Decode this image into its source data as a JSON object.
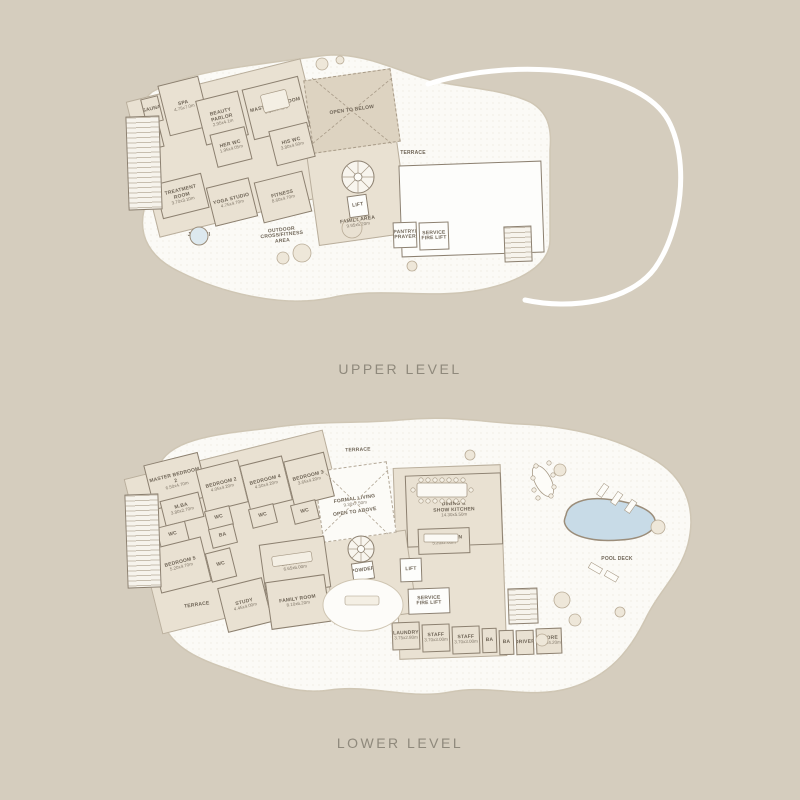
{
  "titles": {
    "upper": "UPPER LEVEL",
    "lower": "LOWER LEVEL"
  },
  "colors": {
    "background": "#d5cdbe",
    "deck": "#fbfaf6",
    "room": "#e9e1d2",
    "wall": "#8c8070",
    "open_fill": "#ddd3c1",
    "pool": "#c8dbe7",
    "text": "#6f6557",
    "title_text": "#8f897c",
    "boundary": "#ffffff"
  },
  "upper_plan": {
    "rooms": [
      {
        "id": "wing-slab",
        "name": "",
        "x": 140,
        "y": 78,
        "w": 180,
        "h": 140,
        "r": -14,
        "type": "slab"
      },
      {
        "id": "mid-slab",
        "name": "",
        "x": 312,
        "y": 146,
        "w": 92,
        "h": 94,
        "r": -8,
        "type": "slab"
      },
      {
        "id": "right-wing",
        "name": "",
        "x": 400,
        "y": 163,
        "w": 143,
        "h": 92,
        "r": -2,
        "type": "white"
      },
      {
        "id": "open-to-below",
        "name": "OPEN TO BELOW",
        "x": 308,
        "y": 74,
        "w": 88,
        "h": 74,
        "r": -8,
        "type": "open"
      },
      {
        "id": "sauna",
        "name": "SAUNA",
        "x": 143,
        "y": 97,
        "w": 18,
        "h": 26,
        "r": -14,
        "type": "std"
      },
      {
        "id": "steam",
        "name": "STEAM",
        "x": 144,
        "y": 125,
        "w": 18,
        "h": 24,
        "r": -14,
        "type": "std"
      },
      {
        "id": "spa",
        "name": "SPA",
        "dims": "4.75x7.0m",
        "x": 163,
        "y": 80,
        "w": 42,
        "h": 52,
        "r": -14,
        "type": "std"
      },
      {
        "id": "beauty-parlor",
        "name": "BEAUTY PARLOR",
        "dims": "2.95x4.1m",
        "x": 200,
        "y": 95,
        "w": 44,
        "h": 46,
        "r": -14,
        "type": "std"
      },
      {
        "id": "master-bedroom",
        "name": "MASTER BEDROOM",
        "dims": "8.35x4.45m",
        "x": 247,
        "y": 82,
        "w": 58,
        "h": 52,
        "r": -14,
        "type": "std"
      },
      {
        "id": "her-wc",
        "name": "HER WC",
        "dims": "1.95x4.05m",
        "x": 213,
        "y": 130,
        "w": 36,
        "h": 34,
        "r": -14,
        "type": "std"
      },
      {
        "id": "his-wc",
        "name": "HIS WC",
        "dims": "3.80x4.50m",
        "x": 272,
        "y": 126,
        "w": 40,
        "h": 36,
        "r": -14,
        "type": "std"
      },
      {
        "id": "treatment-room",
        "name": "TREATMENT ROOM",
        "dims": "3.70x3.10m",
        "x": 158,
        "y": 178,
        "w": 48,
        "h": 36,
        "r": -14,
        "type": "std"
      },
      {
        "id": "yoga-studio",
        "name": "YOGA STUDIO",
        "dims": "4.75x4.70m",
        "x": 210,
        "y": 182,
        "w": 44,
        "h": 40,
        "r": -14,
        "type": "std"
      },
      {
        "id": "fitness",
        "name": "FITNESS",
        "dims": "8.60x4.70m",
        "x": 258,
        "y": 176,
        "w": 50,
        "h": 42,
        "r": -14,
        "type": "std"
      },
      {
        "id": "lift",
        "name": "LIFT",
        "x": 348,
        "y": 195,
        "w": 20,
        "h": 22,
        "r": -8,
        "type": "white"
      },
      {
        "id": "pantry-prayer",
        "name": "PANTRY/\nPRAYER",
        "x": 393,
        "y": 222,
        "w": 24,
        "h": 26,
        "r": -2,
        "type": "white"
      },
      {
        "id": "service-fire-lift",
        "name": "SERVICE\nFIRE LIFT",
        "x": 419,
        "y": 222,
        "w": 30,
        "h": 28,
        "r": -2,
        "type": "white"
      },
      {
        "id": "stair-right",
        "name": "",
        "x": 504,
        "y": 226,
        "w": 28,
        "h": 36,
        "r": -2,
        "type": "stairbox"
      },
      {
        "id": "core-left",
        "name": "",
        "x": 127,
        "y": 116,
        "w": 34,
        "h": 94,
        "r": -2,
        "type": "stairbox"
      },
      {
        "id": "family-area-label",
        "name": "FAMILY AREA",
        "dims": "9.95x5.20m",
        "x": 322,
        "y": 214,
        "w": 72,
        "h": 18,
        "r": -8,
        "type": "label"
      },
      {
        "id": "terrace-label",
        "name": "TERRACE",
        "x": 392,
        "y": 148,
        "w": 42,
        "h": 12,
        "r": 0,
        "type": "label"
      },
      {
        "id": "outdoor-area-label",
        "name": "OUTDOOR\nCROSS/FITNESS\nAREA",
        "x": 248,
        "y": 224,
        "w": 68,
        "h": 24,
        "r": -6,
        "type": "label"
      },
      {
        "id": "jacuzzi-label",
        "name": "JACUZZI",
        "x": 185,
        "y": 230,
        "w": 28,
        "h": 12,
        "r": 0,
        "type": "label"
      }
    ]
  },
  "lower_plan": {
    "rooms": [
      {
        "id": "wing-slab",
        "name": "",
        "x": 140,
        "y": 452,
        "w": 205,
        "h": 160,
        "r": -14,
        "type": "slab"
      },
      {
        "id": "right-slab",
        "name": "",
        "x": 396,
        "y": 466,
        "w": 108,
        "h": 192,
        "r": -2,
        "type": "slab"
      },
      {
        "id": "mid-slab",
        "name": "",
        "x": 328,
        "y": 535,
        "w": 84,
        "h": 84,
        "r": -8,
        "type": "slab"
      },
      {
        "id": "formal-living",
        "name": "FORMAL LIVING",
        "dims": "9.30x7.50m",
        "x": 318,
        "y": 466,
        "w": 74,
        "h": 72,
        "r": -8,
        "type": "openwhite"
      },
      {
        "id": "master-bedroom-2",
        "name": "MASTER BEDROOM 2",
        "dims": "6.50x4.70m",
        "x": 148,
        "y": 458,
        "w": 56,
        "h": 46,
        "r": -14,
        "type": "std"
      },
      {
        "id": "m-ba",
        "name": "M.BA",
        "dims": "3.80x2.70m",
        "x": 162,
        "y": 496,
        "w": 40,
        "h": 26,
        "r": -14,
        "type": "std"
      },
      {
        "id": "wc-mb2",
        "name": "WC",
        "x": 158,
        "y": 524,
        "w": 30,
        "h": 22,
        "r": -14,
        "type": "std"
      },
      {
        "id": "bedroom-5",
        "name": "BEDROOM 5",
        "dims": "5.20x4.70m",
        "x": 155,
        "y": 542,
        "w": 52,
        "h": 46,
        "r": -14,
        "type": "std"
      },
      {
        "id": "wc-b5",
        "name": "WC",
        "x": 208,
        "y": 550,
        "w": 26,
        "h": 30,
        "r": -14,
        "type": "std"
      },
      {
        "id": "bedroom-2",
        "name": "BEDROOM 2",
        "dims": "4.05x4.20m",
        "x": 200,
        "y": 464,
        "w": 44,
        "h": 44,
        "r": -14,
        "type": "std"
      },
      {
        "id": "wc-b2",
        "name": "WC",
        "x": 206,
        "y": 508,
        "w": 26,
        "h": 20,
        "r": -14,
        "type": "std"
      },
      {
        "id": "ba-b2",
        "name": "BA",
        "x": 210,
        "y": 526,
        "w": 26,
        "h": 20,
        "r": -14,
        "type": "std"
      },
      {
        "id": "bedroom-4",
        "name": "BEDROOM 4",
        "dims": "4.50x4.20m",
        "x": 244,
        "y": 460,
        "w": 44,
        "h": 46,
        "r": -14,
        "type": "std"
      },
      {
        "id": "wc-b4",
        "name": "WC",
        "x": 250,
        "y": 506,
        "w": 26,
        "h": 20,
        "r": -14,
        "type": "std"
      },
      {
        "id": "bedroom-3",
        "name": "BEDROOM 3",
        "dims": "3.65x4.20m",
        "x": 288,
        "y": 456,
        "w": 42,
        "h": 46,
        "r": -14,
        "type": "std"
      },
      {
        "id": "wc-b3",
        "name": "WC",
        "x": 292,
        "y": 502,
        "w": 26,
        "h": 20,
        "r": -14,
        "type": "std"
      },
      {
        "id": "dining-show-kitchen",
        "name": "DINING &\nSHOW KITCHEN",
        "dims": "14.30x5.50m",
        "x": 406,
        "y": 474,
        "w": 96,
        "h": 72,
        "r": -2,
        "type": "std"
      },
      {
        "id": "wet-kitchen",
        "name": "WET KITCHEN",
        "dims": "5.20x2.60m",
        "x": 418,
        "y": 528,
        "w": 52,
        "h": 26,
        "r": -2,
        "type": "std"
      },
      {
        "id": "lift",
        "name": "LIFT",
        "x": 400,
        "y": 558,
        "w": 22,
        "h": 24,
        "r": -2,
        "type": "white"
      },
      {
        "id": "media-room",
        "name": "MEDIA ROOM",
        "dims": "6.65x6.00m",
        "x": 262,
        "y": 540,
        "w": 66,
        "h": 52,
        "r": -8,
        "type": "std"
      },
      {
        "id": "study",
        "name": "STUDY",
        "dims": "4.45x4.00m",
        "x": 222,
        "y": 582,
        "w": 46,
        "h": 46,
        "r": -14,
        "type": "std"
      },
      {
        "id": "family-room",
        "name": "FAMILY ROOM",
        "dims": "8.10x6.20m",
        "x": 268,
        "y": 578,
        "w": 60,
        "h": 48,
        "r": -8,
        "type": "std"
      },
      {
        "id": "powder",
        "name": "POWDER",
        "x": 352,
        "y": 562,
        "w": 22,
        "h": 18,
        "r": -8,
        "type": "white"
      },
      {
        "id": "service-fire-lift",
        "name": "SERVICE\nFIRE LIFT",
        "x": 408,
        "y": 588,
        "w": 42,
        "h": 26,
        "r": -2,
        "type": "white"
      },
      {
        "id": "stair-right",
        "name": "",
        "x": 508,
        "y": 588,
        "w": 30,
        "h": 36,
        "r": -2,
        "type": "stairbox"
      },
      {
        "id": "laundry",
        "name": "LAUNDRY",
        "dims": "3.75x2.80m",
        "x": 392,
        "y": 622,
        "w": 28,
        "h": 28,
        "r": -2,
        "type": "std"
      },
      {
        "id": "staff-1",
        "name": "STAFF",
        "dims": "3.70x3.00m",
        "x": 422,
        "y": 624,
        "w": 28,
        "h": 28,
        "r": -2,
        "type": "std"
      },
      {
        "id": "staff-2",
        "name": "STAFF",
        "dims": "3.70x3.00m",
        "x": 452,
        "y": 626,
        "w": 28,
        "h": 28,
        "r": -2,
        "type": "std"
      },
      {
        "id": "ba-1",
        "name": "BA",
        "x": 482,
        "y": 628,
        "w": 15,
        "h": 25,
        "r": -2,
        "type": "std"
      },
      {
        "id": "ba-2",
        "name": "BA",
        "x": 499,
        "y": 630,
        "w": 15,
        "h": 25,
        "r": -2,
        "type": "std"
      },
      {
        "id": "driver",
        "name": "DRIVER",
        "x": 516,
        "y": 630,
        "w": 18,
        "h": 25,
        "r": -2,
        "type": "std"
      },
      {
        "id": "store",
        "name": "STORE",
        "dims": "3.30x4.20m",
        "x": 536,
        "y": 628,
        "w": 26,
        "h": 26,
        "r": -2,
        "type": "std"
      },
      {
        "id": "core-left",
        "name": "",
        "x": 126,
        "y": 494,
        "w": 34,
        "h": 94,
        "r": -2,
        "type": "stairbox"
      },
      {
        "id": "open-above-label",
        "name": "OPEN TO ABOVE",
        "x": 325,
        "y": 508,
        "w": 60,
        "h": 10,
        "r": -8,
        "type": "label"
      },
      {
        "id": "family-lounge-label",
        "name": "FAMILY LOUNGE",
        "dims": "6.70x5.40m",
        "x": 333,
        "y": 596,
        "w": 60,
        "h": 22,
        "r": 0,
        "type": "label"
      },
      {
        "id": "terrace-top-label",
        "name": "TERRACE",
        "x": 336,
        "y": 446,
        "w": 44,
        "h": 10,
        "r": -2,
        "type": "label"
      },
      {
        "id": "terrace-left-label",
        "name": "TERRACE",
        "x": 177,
        "y": 600,
        "w": 40,
        "h": 12,
        "r": -8,
        "type": "label"
      },
      {
        "id": "pool-label",
        "name": "POOL",
        "x": 592,
        "y": 514,
        "w": 36,
        "h": 12,
        "r": 0,
        "type": "label"
      },
      {
        "id": "pool-deck-label",
        "name": "POOL DECK",
        "x": 597,
        "y": 554,
        "w": 40,
        "h": 12,
        "r": 0,
        "type": "label"
      }
    ]
  }
}
